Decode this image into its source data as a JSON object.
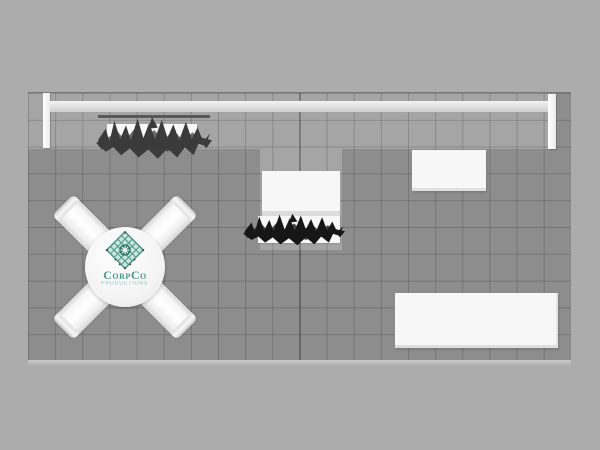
{
  "scene": {
    "type": "trade-show-booth-top-down-render"
  },
  "logo": {
    "name": "CorpCo",
    "subtitle": "PRODUCTIONS"
  },
  "colors": {
    "bg": "#acacac",
    "floor": "#8d8d8d",
    "zone": "#a5a5a5",
    "grid": "rgba(0,0,0,0.16)",
    "white": "#f7f7f7",
    "strip": "#585858",
    "foliageGray": "#3b3b3b",
    "foliageDark": "#161616",
    "teal": "#49988c",
    "tealDark": "#2e7a6f",
    "tealLight": "#8cc2b7",
    "mint": "#cde6dd",
    "edge": "#c2c2c2"
  },
  "objects": [
    "back-wall-beam",
    "upright-post-left",
    "upright-post-right",
    "header-graphic-strip",
    "hedge-planter-left",
    "hedge-planter-center",
    "counter-center",
    "counter-right",
    "table-bottom-right",
    "round-meeting-table",
    "chairs-x-layout"
  ]
}
